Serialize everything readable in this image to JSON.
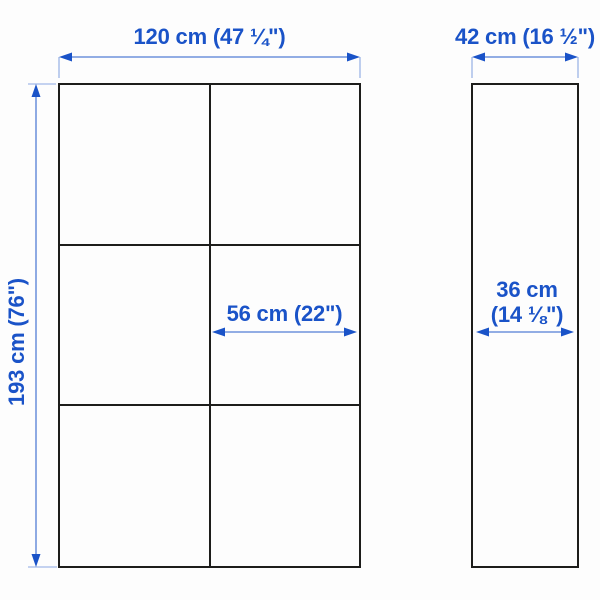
{
  "colors": {
    "dimension_blue": "#1a53c8",
    "outline_black": "#1d1d1b",
    "background": "#fdfdfd"
  },
  "front_view": {
    "grid_rows": 3,
    "grid_columns": 2,
    "width_label": "120 cm (47 ¼\")",
    "height_label": "193 cm (76\")",
    "inner_width_label": "56 cm (22\")"
  },
  "side_view": {
    "depth_label": "42 cm (16 ½\")",
    "inner_depth_label": [
      "36 cm",
      "(14 ⅛\")"
    ]
  }
}
